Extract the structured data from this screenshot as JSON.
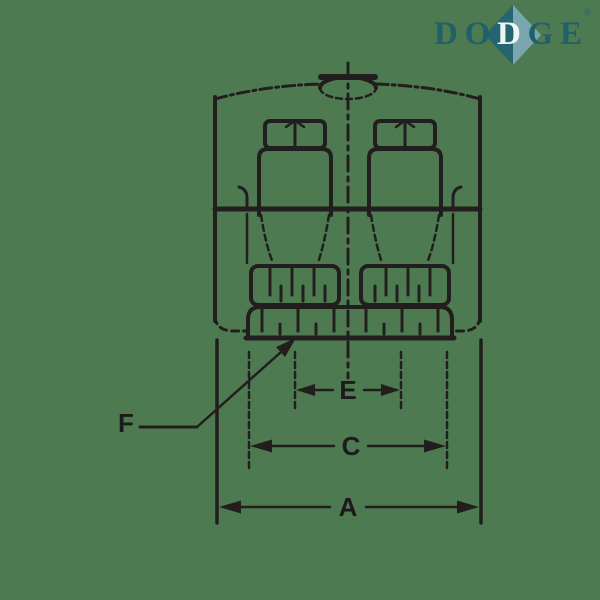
{
  "page": {
    "background_color": "#4e7a52",
    "line_color": "#221e1e"
  },
  "logo": {
    "letters": [
      "D",
      "O",
      "D",
      "G",
      "E"
    ],
    "registered_mark": "®",
    "text_color": "#215f6b",
    "diamond_left_color": "#24656f",
    "diamond_right_color": "#7aa6b0"
  },
  "drawing": {
    "labels": {
      "a": "A",
      "c": "C",
      "e": "E",
      "f": "F"
    }
  }
}
